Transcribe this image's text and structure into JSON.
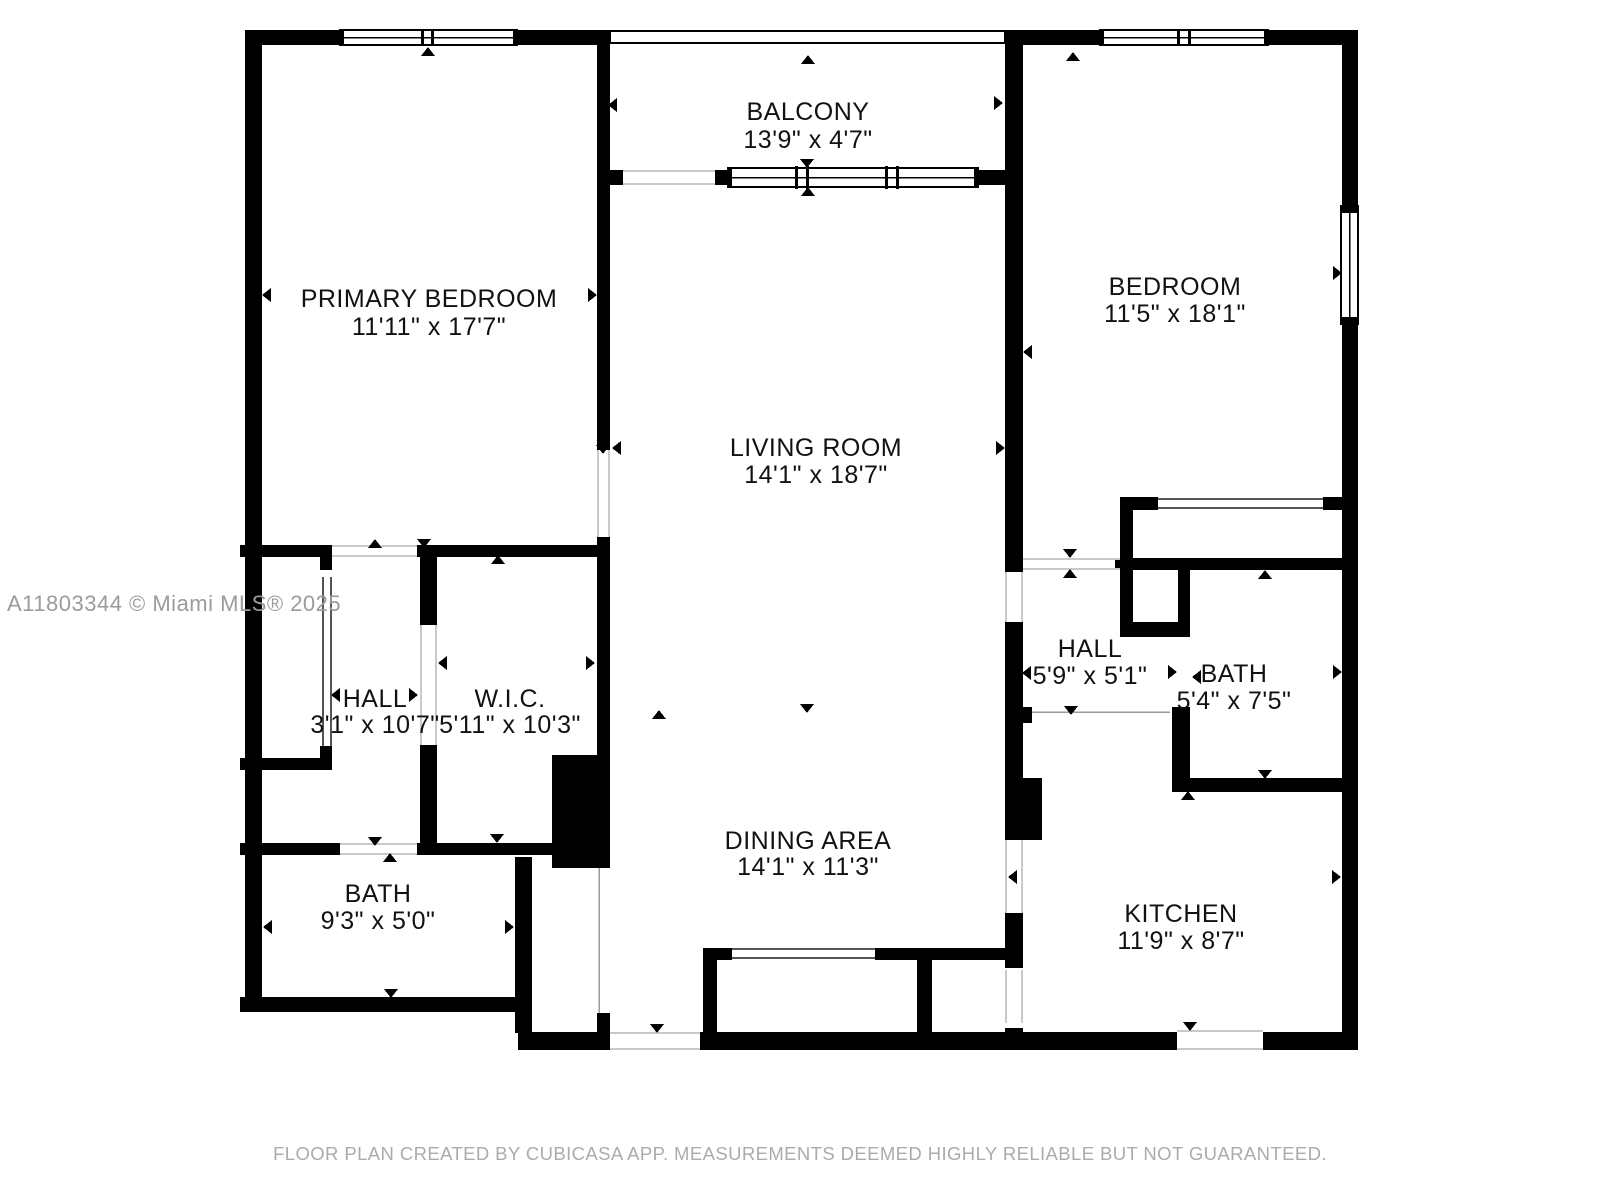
{
  "page": {
    "watermark": "A11803344 © Miami MLS® 2025",
    "footer": "FLOOR PLAN CREATED BY CUBICASA APP. MEASUREMENTS DEEMED HIGHLY RELIABLE BUT NOT GUARANTEED."
  },
  "rooms": [
    {
      "id": "primary-bedroom",
      "name": "PRIMARY BEDROOM",
      "dims": "11'11\" x 17'7\""
    },
    {
      "id": "balcony",
      "name": "BALCONY",
      "dims": "13'9\" x 4'7\""
    },
    {
      "id": "bedroom",
      "name": "BEDROOM",
      "dims": "11'5\" x 18'1\""
    },
    {
      "id": "living-room",
      "name": "LIVING ROOM",
      "dims": "14'1\" x 18'7\""
    },
    {
      "id": "hall-left",
      "name": "HALL",
      "dims": "3'1\" x 10'7\""
    },
    {
      "id": "wic",
      "name": "W.I.C.",
      "dims": "5'11\" x 10'3\""
    },
    {
      "id": "bath-left",
      "name": "BATH",
      "dims": "9'3\" x 5'0\""
    },
    {
      "id": "hall-right",
      "name": "HALL",
      "dims": "5'9\" x 5'1\""
    },
    {
      "id": "bath-right",
      "name": "BATH",
      "dims": "5'4\" x 7'5\""
    },
    {
      "id": "dining-area",
      "name": "DINING AREA",
      "dims": "14'1\" x 11'3\""
    },
    {
      "id": "kitchen",
      "name": "KITCHEN",
      "dims": "11'9\" x 8'7\""
    }
  ],
  "colors": {
    "wall": "#000000",
    "text": "#111111",
    "watermark": "#9b9b9b",
    "footer": "#ababab",
    "background": "#ffffff"
  }
}
